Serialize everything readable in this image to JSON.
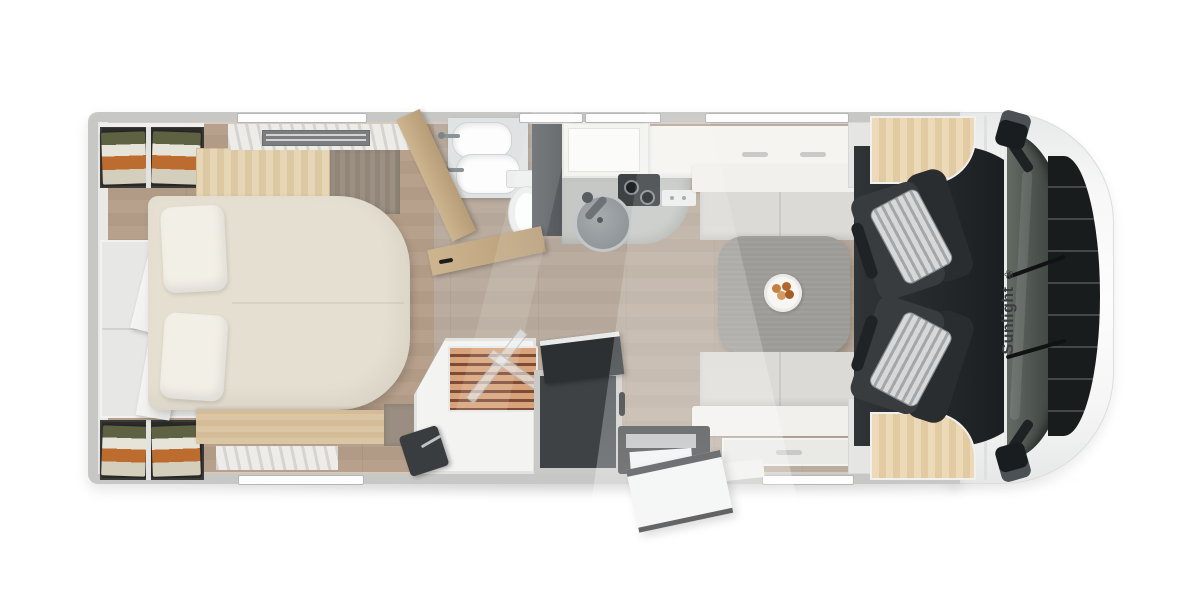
{
  "scene": {
    "title": "Motorhome floor plan - top-down render",
    "background": "#ffffff"
  },
  "branding": {
    "name": "Sunlight",
    "logo_icon": "flower-icon",
    "logo_glyph": "❀",
    "color": "#3a3d40"
  },
  "palette": {
    "outer_wall": "#c7c8c6",
    "floor_wood": "#b3a190",
    "bed": "#e5dfd1",
    "light_wood": "#e2cba3",
    "taupe_wall": "#998e81",
    "table": "#9c9b97",
    "bench_cushion": "#dbdad6",
    "seat_dark": "#33373a",
    "seat_stripe": "#d6d8d9",
    "shower_slats": "#d8a37a",
    "dark_cabinet": "#3e4245",
    "cab_interior": "#212527",
    "windshield": "#4b524d",
    "grille": "#191c1d",
    "clothes_green": "#5e6243",
    "clothes_orange": "#bb6c2e"
  },
  "rooms": {
    "bedroom": [
      "rear-wardrobe-top",
      "rear-wardrobe-bottom",
      "rear-cabinet-open-doors",
      "double-bed",
      "pillow-left",
      "pillow-right",
      "headboard-cabinet",
      "foot-bench",
      "ceiling-vent",
      "curtain"
    ],
    "bathroom": [
      "washbasin-1",
      "washbasin-2",
      "toilet",
      "dark-partition",
      "open-wood-door-1",
      "open-wood-door-2"
    ],
    "shower": [
      "shower-tray",
      "wood-grate",
      "glass-door-1",
      "glass-door-2",
      "hand-shower"
    ],
    "kitchen": [
      "overhead-cabinet",
      "worktop",
      "grey-counter",
      "round-sink",
      "sink-faucet",
      "two-burner-hob",
      "control-panel"
    ],
    "dinette": [
      "bench-top-backrest",
      "bench-top-cushions",
      "dining-table",
      "plate-with-food",
      "bench-bottom-cushions",
      "bench-bottom-backrest",
      "sideboard-drawer"
    ],
    "cab": [
      "passenger-seat",
      "driver-seat",
      "dashboard-wood-top",
      "dashboard-wood-bottom",
      "windshield",
      "front-grille",
      "wing-mirror-top",
      "wing-mirror-bottom"
    ],
    "entrance": [
      "step-well",
      "entry-step",
      "entry-door",
      "door-sill"
    ]
  }
}
